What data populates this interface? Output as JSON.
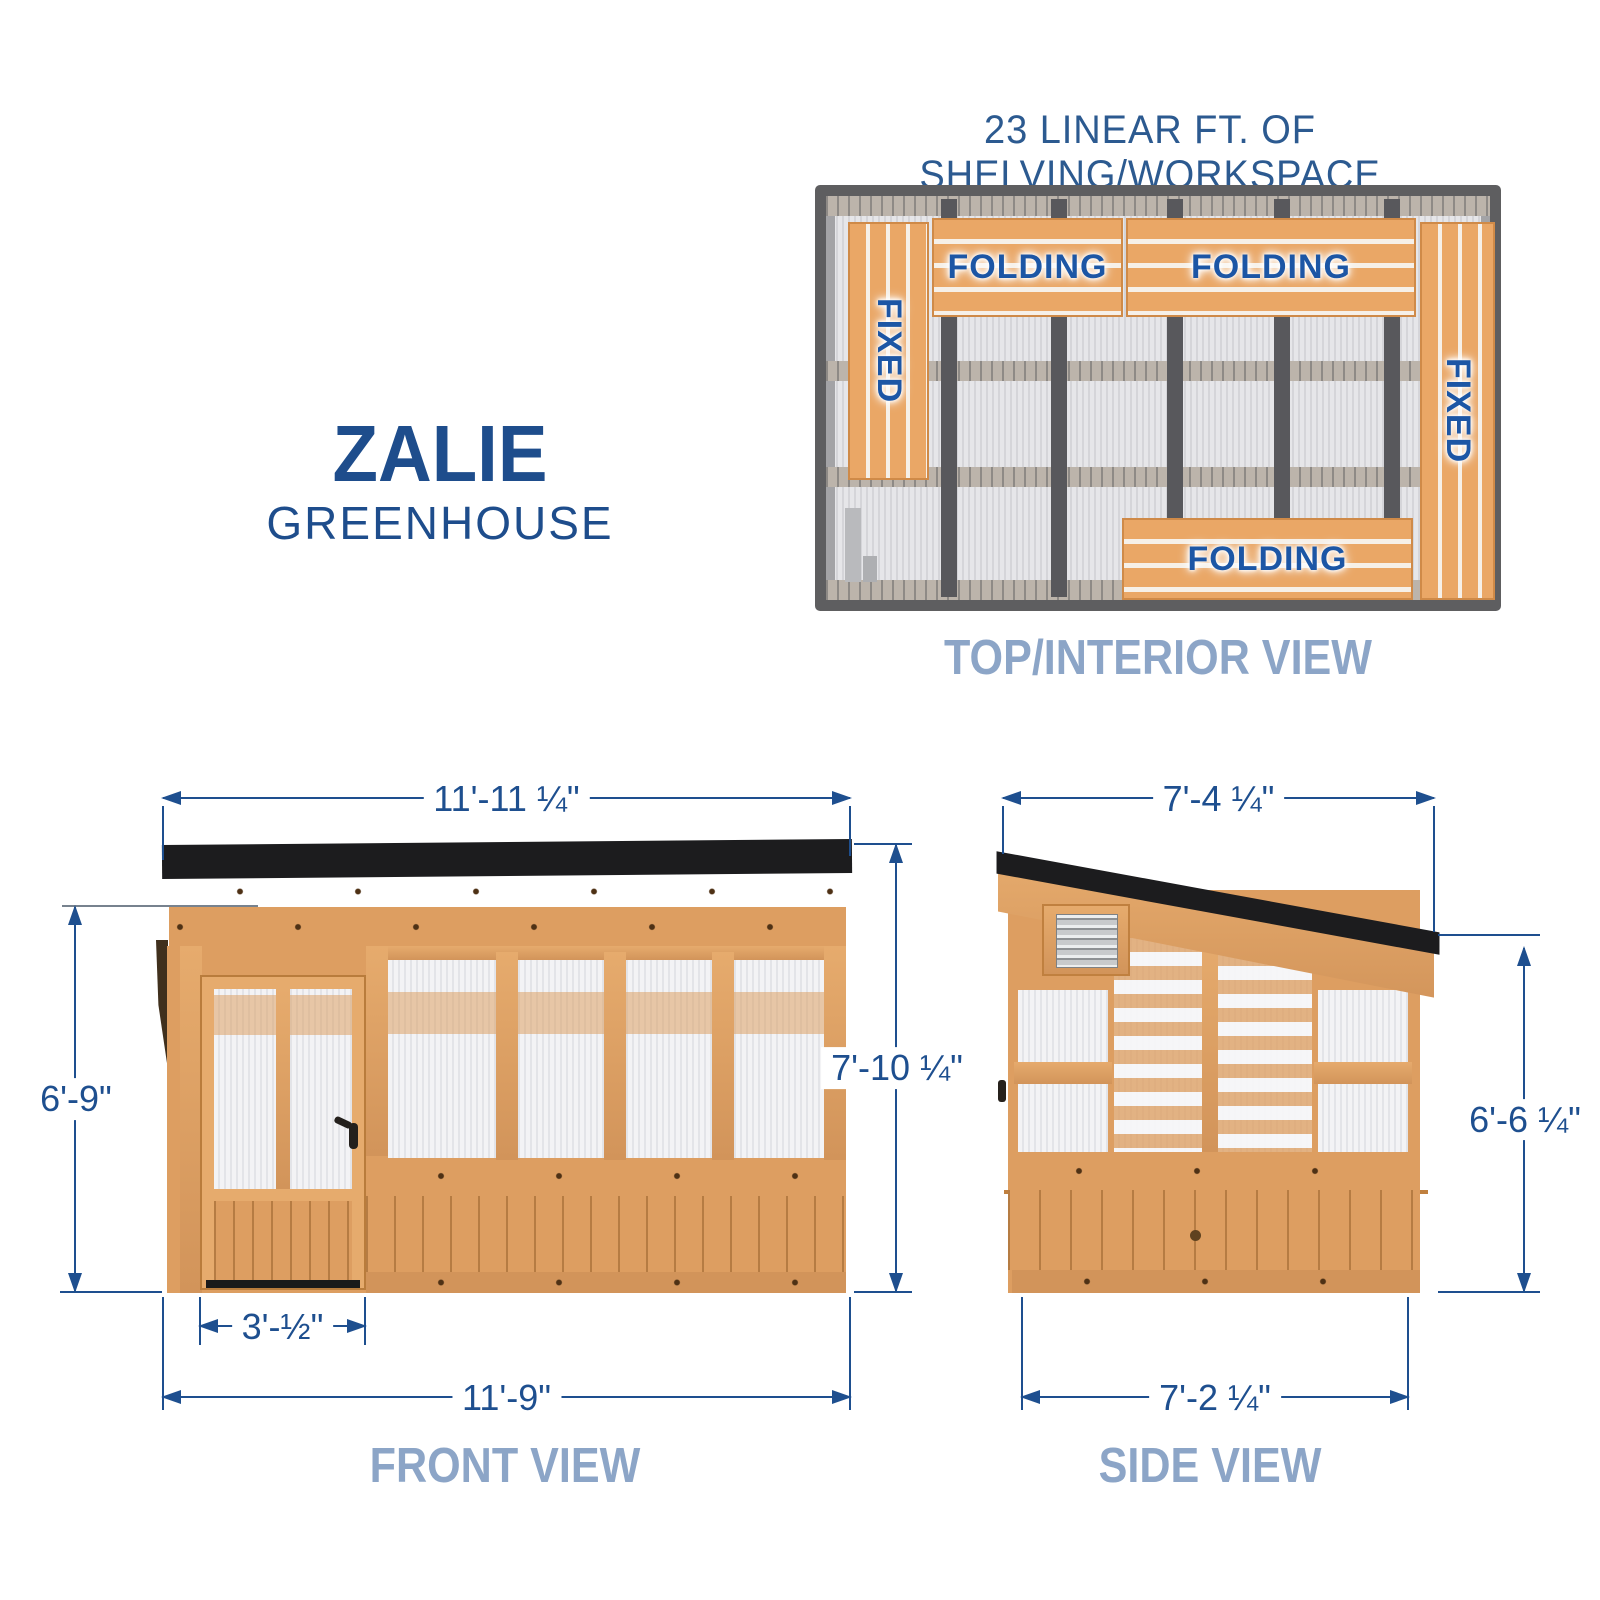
{
  "colors": {
    "dimension_blue": "#1e4f8f",
    "caption_blue": "#8ca5c7",
    "title_blue": "#1e4d8c",
    "wood": "#dd9e61",
    "roof_black": "#1c1c1e",
    "frame_gray": "#5e5e60"
  },
  "header": {
    "note": "23 LINEAR FT. OF SHELVING/WORKSPACE"
  },
  "brand": {
    "name": "ZALIE",
    "sub": "GREENHOUSE"
  },
  "views": {
    "top": {
      "caption": "TOP/INTERIOR VIEW",
      "shelves": [
        {
          "label": "FIXED",
          "type": "fixed",
          "position": "left"
        },
        {
          "label": "FOLDING",
          "type": "folding",
          "position": "top-left"
        },
        {
          "label": "FOLDING",
          "type": "folding",
          "position": "top-right"
        },
        {
          "label": "FIXED",
          "type": "fixed",
          "position": "right"
        },
        {
          "label": "FOLDING",
          "type": "folding",
          "position": "bottom"
        }
      ]
    },
    "front": {
      "caption": "FRONT VIEW",
      "dims": {
        "overall_width_top": "11'-11 ¼\"",
        "door_height": "6'-9\"",
        "overall_height": "7'-10 ¼\"",
        "door_width": "3'-½\"",
        "base_width": "11'-9\""
      }
    },
    "side": {
      "caption": "SIDE VIEW",
      "dims": {
        "overall_depth_top": "7'-4 ¼\"",
        "wall_height": "6'-6 ¼\"",
        "base_depth": "7'-2 ¼\""
      }
    }
  }
}
